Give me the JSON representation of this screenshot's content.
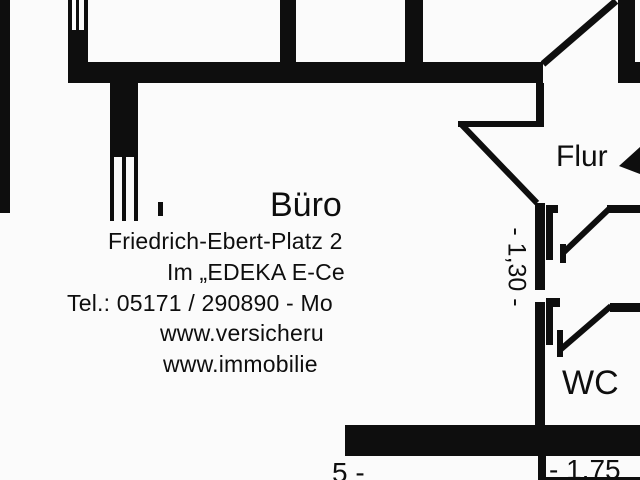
{
  "colors": {
    "ink": "#0e0e0e",
    "background": "#fbfbfb"
  },
  "floor_plan": {
    "room_labels": {
      "hallway": "Flur",
      "wc": "WC"
    },
    "dimensions": {
      "hallway_height": "- 1,30 -",
      "wc_width_partial": "- 1,75",
      "left_width_partial": "5 -",
      "right_height_partial": "95"
    }
  },
  "overlay_text": {
    "title": "Büro",
    "address": "Friedrich-Ebert-Platz 2",
    "location": "Im „EDEKA E-Ce",
    "phone": "Tel.: 05171 / 290890 - Mo",
    "website1": "www.versicheru",
    "website2": "www.immobilie"
  }
}
